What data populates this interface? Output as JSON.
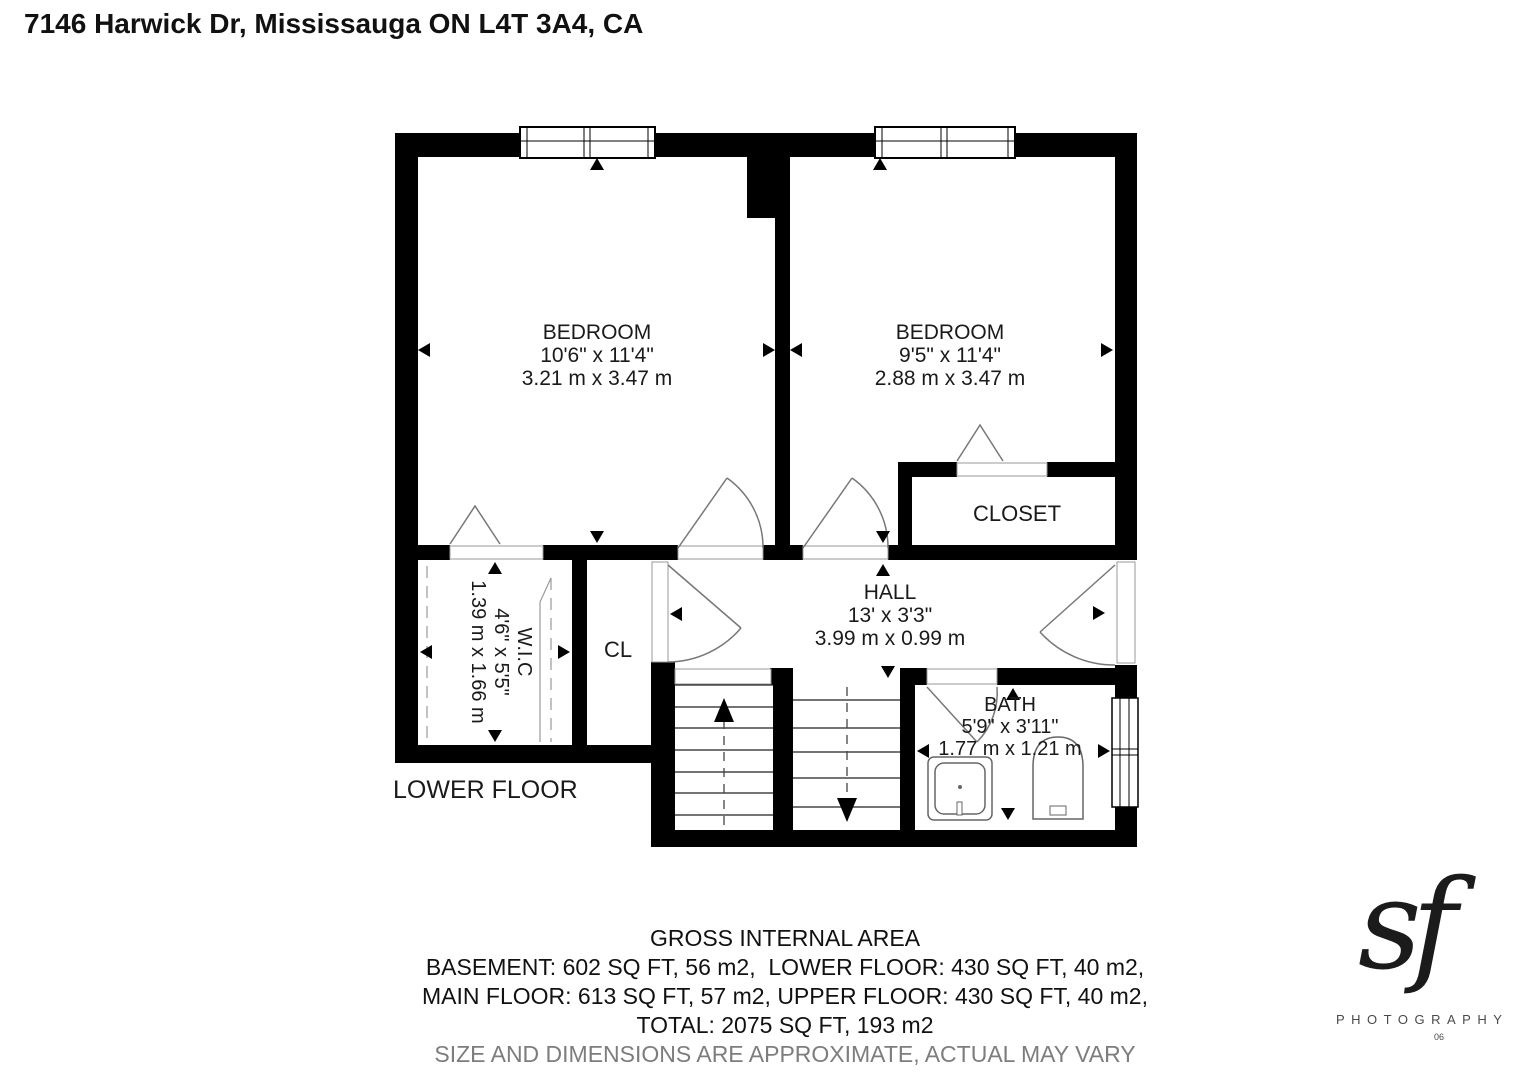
{
  "title": "7146 Harwick Dr, Mississauga ON L4T 3A4, CA",
  "floor_label": "LOWER FLOOR",
  "rooms": {
    "bedroom1": {
      "name": "BEDROOM",
      "imperial": "10'6\" x 11'4\"",
      "metric": "3.21 m x 3.47 m"
    },
    "bedroom2": {
      "name": "BEDROOM",
      "imperial": "9'5\" x 11'4\"",
      "metric": "2.88 m x 3.47 m"
    },
    "closet": {
      "name": "CLOSET"
    },
    "cl": {
      "name": "CL"
    },
    "wic": {
      "name": "W.I.C",
      "imperial": "4'6\" x 5'5\"",
      "metric": "1.39 m x 1.66 m"
    },
    "hall": {
      "name": "HALL",
      "imperial": "13' x 3'3\"",
      "metric": "3.99 m x 0.99 m"
    },
    "bath": {
      "name": "BATH",
      "imperial": "5'9\" x 3'11\"",
      "metric": "1.77 m x 1.21 m"
    }
  },
  "footer": {
    "heading": "GROSS INTERNAL AREA",
    "line1": "BASEMENT: 602 SQ FT, 56 m2,  LOWER FLOOR: 430 SQ FT, 40 m2,",
    "line2": "MAIN FLOOR: 613 SQ FT, 57 m2, UPPER FLOOR: 430 SQ FT, 40 m2,",
    "line3": "TOTAL: 2075 SQ FT, 193 m2",
    "disclaimer": "SIZE AND DIMENSIONS ARE APPROXIMATE, ACTUAL MAY VARY"
  },
  "logo": {
    "script": "sf",
    "text": "PHOTOGRAPHY",
    "number": "06"
  },
  "colors": {
    "wall": "#000000",
    "thin_line": "#777777",
    "disclaimer": "#7d7d7d"
  }
}
